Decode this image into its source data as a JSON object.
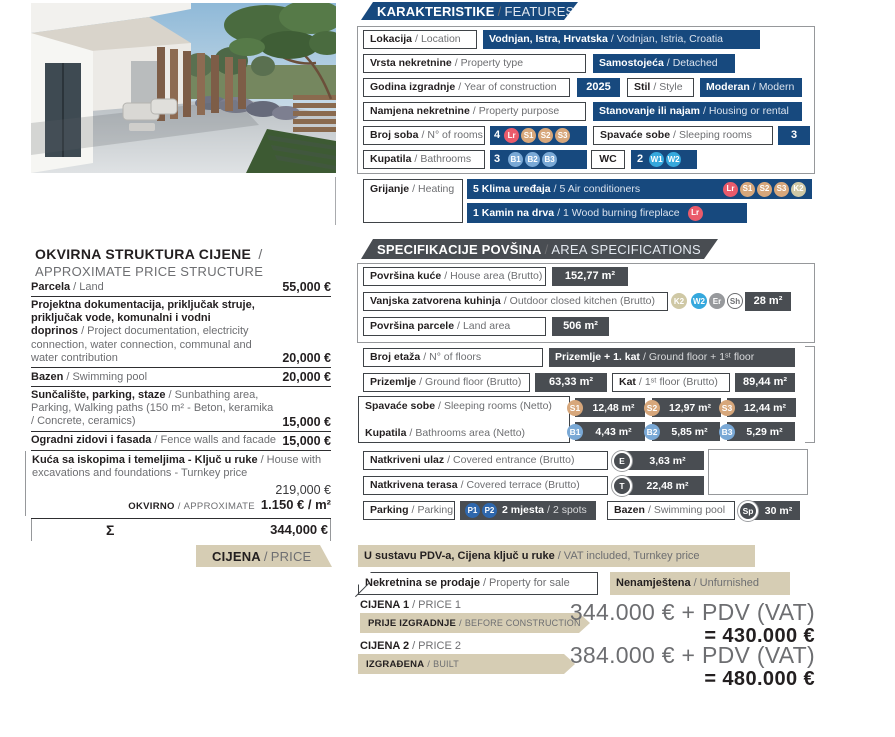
{
  "separator": "/",
  "features": {
    "title_hr": "KARAKTERISTIKE",
    "title_en": "FEATURES",
    "location": {
      "label_hr": "Lokacija",
      "label_en": "Location",
      "value_hr": "Vodnjan, Istra, Hrvatska",
      "value_en": "Vodnjan, Istria, Croatia"
    },
    "property_type": {
      "label_hr": "Vrsta nekretnine",
      "label_en": "Property type",
      "value_hr": "Samostojeća",
      "value_en": "Detached"
    },
    "year": {
      "label_hr": "Godina izgradnje",
      "label_en": "Year of construction",
      "value": "2025"
    },
    "style": {
      "label_hr": "Stil",
      "label_en": "Style",
      "value_hr": "Moderan",
      "value_en": "Modern"
    },
    "purpose": {
      "label_hr": "Namjena nekretnine",
      "label_en": "Property purpose",
      "value_hr": "Stanovanje ili najam",
      "value_en": "Housing or rental"
    },
    "rooms": {
      "label_hr": "Broj soba",
      "label_en": "N° of rooms",
      "count": "4",
      "badges": [
        "Lr",
        "S1",
        "S2",
        "S3"
      ]
    },
    "sleeping_rooms": {
      "label_hr": "Spavaće sobe",
      "label_en": "Sleeping rooms",
      "count": "3"
    },
    "bathrooms": {
      "label_hr": "Kupatila",
      "label_en": "Bathrooms",
      "count": "3",
      "badges": [
        "B1",
        "B2",
        "B3"
      ]
    },
    "wc": {
      "label": "WC",
      "count": "2",
      "badges": [
        "W1",
        "W2"
      ]
    },
    "heating": {
      "label_hr": "Grijanje",
      "label_en": "Heating",
      "air_conditioners": {
        "text_hr": "5 Klima uređaja",
        "text_en": "5 Air conditioners",
        "badges": [
          "Lr",
          "S1",
          "S2",
          "S3",
          "K2"
        ]
      },
      "fireplace": {
        "text_hr": "1 Kamin na drva",
        "text_en": "1 Wood burning fireplace",
        "badges": [
          "Lr"
        ]
      }
    }
  },
  "price_structure": {
    "title_hr": "OKVIRNA STRUKTURA CIJENE",
    "title_en": "APPROXIMATE PRICE STRUCTURE",
    "items": [
      {
        "hr": "Parcela",
        "en": "Land",
        "value": "55,000 €"
      },
      {
        "hr": "Projektna dokumentacija, priključak struje, priključak vode, komunalni i vodni doprinos",
        "en": "Project documentation, electricity connection, water connection, communal and water contribution",
        "value": "20,000 €"
      },
      {
        "hr": "Bazen",
        "en": "Swimming pool",
        "value": "20,000 €"
      },
      {
        "hr": "Sunčalište, parking, staze",
        "en": "Sunbathing area, Parking, Walking paths (150 m² - Beton, keramika / Concrete, ceramics)",
        "value": "15,000 €"
      },
      {
        "hr": "Ogradni zidovi i fasada",
        "en": "Fence walls and facade",
        "value": "15,000 €"
      }
    ],
    "turnkey": {
      "hr": "Kuća sa iskopima i  temeljima - Ključ u ruke",
      "en": "House with excavations and foundations - Turnkey price",
      "value": "219,000 €",
      "approx_hr": "OKVIRNO",
      "approx_en": "APPROXIMATE",
      "approx_value": "1.150 € / m²"
    },
    "total_symbol": "Σ",
    "total_value": "344,000 €"
  },
  "areas": {
    "title_hr": "SPECIFIKACIJE POVŠINA",
    "title_en": "AREA SPECIFICATIONS",
    "house_area": {
      "label_hr": "Površina kuće",
      "label_en": "House area (Brutto)",
      "value": "152,77 m²"
    },
    "outdoor_kitchen": {
      "label_hr": "Vanjska zatvorena kuhinja",
      "label_en": "Outdoor closed kitchen (Brutto)",
      "badges": [
        "K2",
        "W2",
        "Er",
        "Sh"
      ],
      "value": "28 m²"
    },
    "land_area": {
      "label_hr": "Površina parcele",
      "label_en": "Land area",
      "value": "506 m²"
    },
    "floors": {
      "label_hr": "Broj etaža",
      "label_en": "N° of floors",
      "value_hr": "Prizemlje + 1. kat",
      "value_en": "Ground floor + 1ˢᵗ floor"
    },
    "ground_floor": {
      "label_hr": "Prizemlje",
      "label_en": "Ground floor (Brutto)",
      "value": "63,33 m²"
    },
    "first_floor": {
      "label_hr": "Kat",
      "label_en": "1ˢᵗ floor (Brutto)",
      "value": "89,44 m²"
    },
    "sleeping_rooms": {
      "label_hr": "Spavaće sobe",
      "label_en": "Sleeping rooms (Netto)",
      "items": [
        {
          "badge": "S1",
          "value": "12,48 m²"
        },
        {
          "badge": "S2",
          "value": "12,97 m²"
        },
        {
          "badge": "S3",
          "value": "12,44 m²"
        }
      ]
    },
    "bathrooms": {
      "label_hr": "Kupatila",
      "label_en": "Bathrooms area (Netto)",
      "items": [
        {
          "badge": "B1",
          "value": "4,43 m²"
        },
        {
          "badge": "B2",
          "value": "5,85 m²"
        },
        {
          "badge": "B3",
          "value": "5,29 m²"
        }
      ]
    },
    "entrance": {
      "label_hr": "Natkriveni ulaz",
      "label_en": "Covered entrance (Brutto)",
      "badge": "E",
      "value": "3,63 m²"
    },
    "terrace": {
      "label_hr": "Natkrivena terasa",
      "label_en": "Covered terrace (Brutto)",
      "badge": "T",
      "value": "22,48 m²"
    },
    "parking": {
      "label_hr": "Parking",
      "label_en": "Parking",
      "badges": [
        "P1",
        "P2"
      ],
      "value_hr": "2 mjesta",
      "value_en": "2 spots"
    },
    "pool": {
      "label_hr": "Bazen",
      "label_en": "Swimming pool",
      "badge": "Sp",
      "value": "30 m²"
    }
  },
  "price": {
    "title_hr": "CIJENA",
    "title_en": "PRICE",
    "vat_hr": "U sustavu PDV-a, Cijena ključ u ruke",
    "vat_en": "VAT included, Turnkey price",
    "sale_hr": "Nekretnina se prodaje",
    "sale_en": "Property for sale",
    "furnished_hr": "Nenamještena",
    "furnished_en": "Unfurnished",
    "price1": {
      "name_hr": "CIJENA 1",
      "name_en": "PRICE 1",
      "stage_hr": "PRIJE IZGRADNJE",
      "stage_en": "BEFORE CONSTRUCTION",
      "amount": "344.000 € + PDV (VAT)",
      "total": "= 430.000 €"
    },
    "price2": {
      "name_hr": "CIJENA 2",
      "name_en": "PRICE 2",
      "stage_hr": "IZGRAĐENA",
      "stage_en": "BUILT",
      "amount": "384.000 € + PDV (VAT)",
      "total": "= 480.000 €"
    }
  },
  "colors": {
    "navy": "#17497E",
    "dark_gray": "#494D52",
    "beige": "#D6CDB4",
    "badge_living_room": "#EA5B6B",
    "badge_sleeping": "#D7A77B",
    "badge_bathroom": "#7AA9D6",
    "badge_wc": "#35A8DD",
    "badge_kitchen": "#CFC8A5",
    "badge_er": "#97999C",
    "badge_parking": "#2E67AD",
    "text_dark": "#231F20",
    "text_gray": "#6D6E71"
  }
}
